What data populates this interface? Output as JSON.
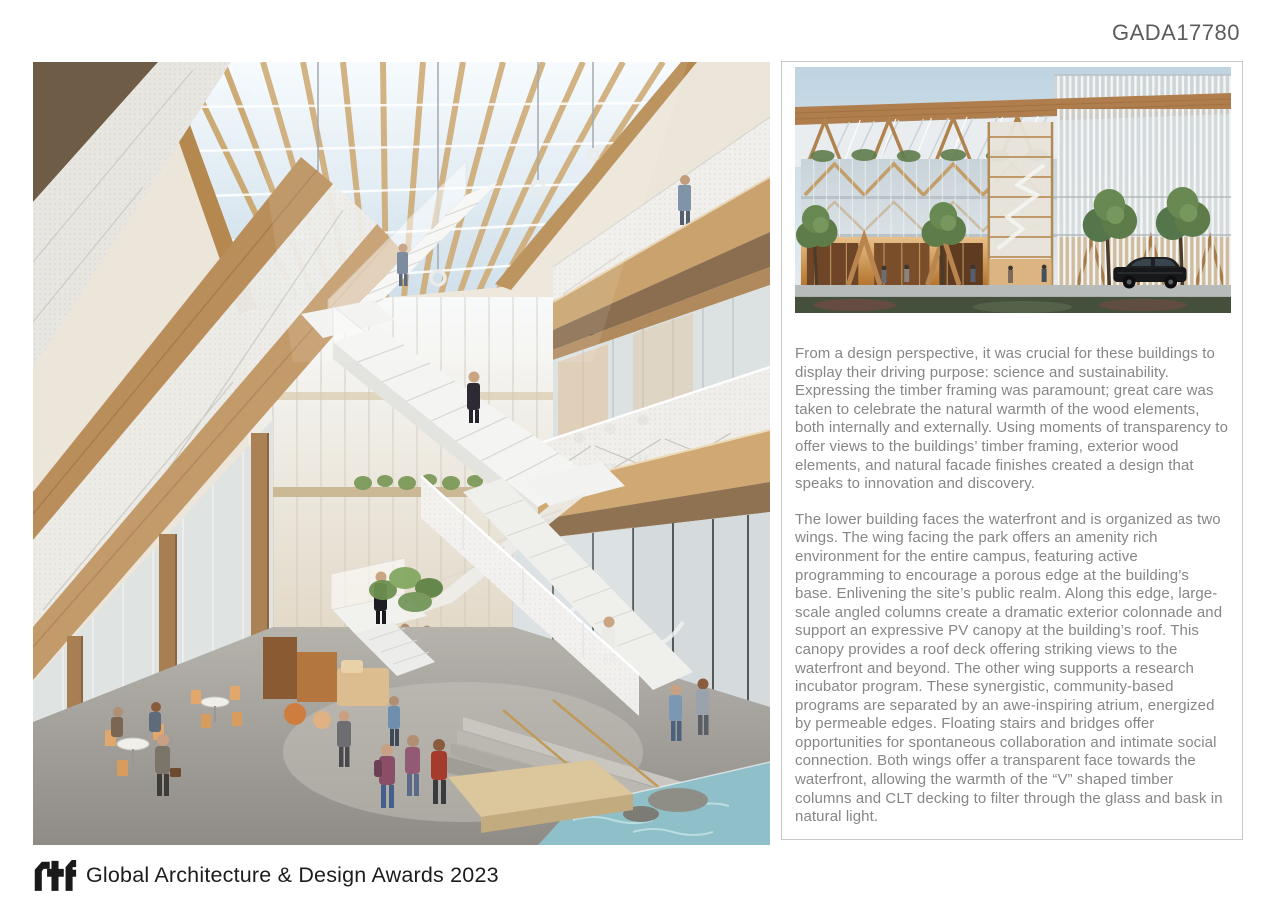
{
  "header": {
    "code": "GADA17780"
  },
  "panel": {
    "paragraph1": "From a design perspective, it was crucial for these buildings to display their driving purpose: science and sustainability. Expressing the timber framing was paramount; great care was taken to celebrate the natural warmth of the wood elements, both internally and externally. Using moments of transparency to offer views to the buildings’ timber framing, exterior wood elements, and natural facade finishes created a design that speaks to innovation and discovery.",
    "paragraph2": "The lower building faces the waterfront and is organized as two wings. The wing facing the park offers an amenity rich environment for the entire campus, featuring active programming to encourage a porous edge at the building’s base. Enlivening the site’s public realm. Along this edge, large-scale angled columns create a dramatic exterior colonnade and support an expressive PV canopy at the building’s roof. This canopy provides a roof deck offering striking views to the waterfront and beyond. The other wing supports a research incubator program. These synergistic, community-based programs are separated by an awe-inspiring atrium, energized by permeable edges. Floating stairs and bridges offer opportunities for spontaneous collaboration and intimate social connection. Both wings offer a transparent face towards the waterfront, allowing the warmth of the “V” shaped timber columns and CLT decking to filter through the glass and bask in natural light."
  },
  "footer": {
    "logo_text": "rtf",
    "award_title": "Global Architecture & Design Awards 2023"
  },
  "colors": {
    "body_text": "#868686",
    "code_text": "#5b5b5b",
    "panel_border": "#c9c9c9",
    "footer_text": "#1c1c1c",
    "wood": "#c2996a",
    "water": "#8fbfc8"
  }
}
